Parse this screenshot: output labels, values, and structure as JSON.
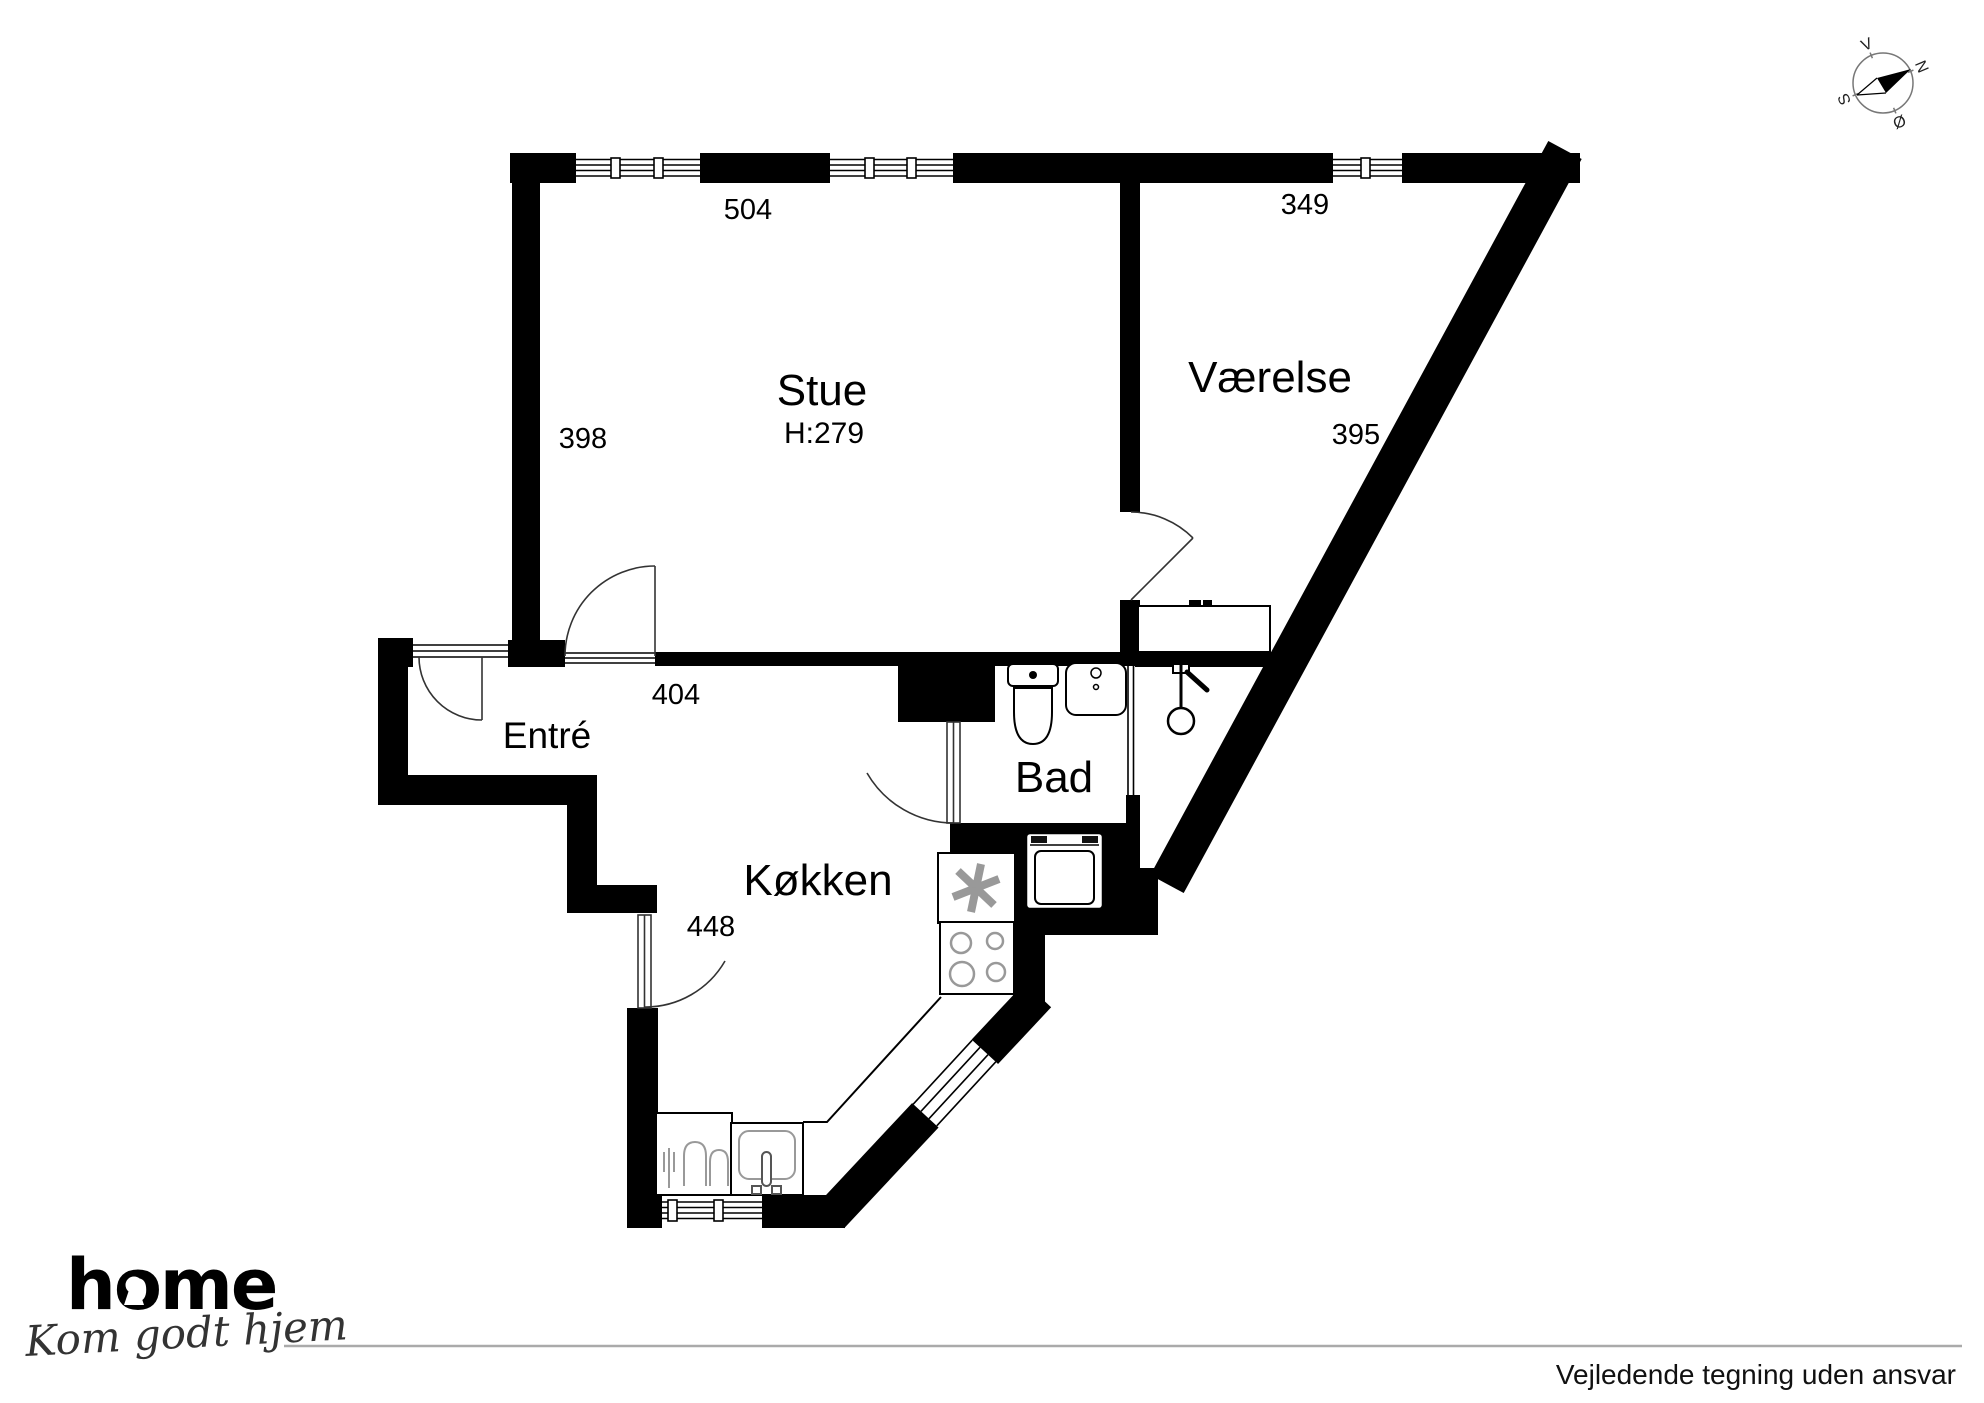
{
  "plan": {
    "rooms": {
      "stue": {
        "label": "Stue",
        "ceiling_height": "H:279",
        "width_cm": "504",
        "depth_cm": "398",
        "opening_cm": "404"
      },
      "vaerelse": {
        "label": "Værelse",
        "width_cm": "349",
        "depth_cm": "395"
      },
      "entre": {
        "label": "Entré"
      },
      "koekken": {
        "label": "Køkken",
        "width_cm": "448"
      },
      "bad": {
        "label": "Bad"
      }
    }
  },
  "compass": {
    "north": "N",
    "south": "S",
    "east": "Ø",
    "west": "V"
  },
  "branding": {
    "logo_text": "home",
    "tagline": "Kom godt hjem",
    "logo_color": "#e6252c"
  },
  "footer": {
    "disclaimer": "Vejledende tegning uden ansvar"
  },
  "colors": {
    "walls": "#000000",
    "fixtures": "#999999",
    "compass_ring": "#777777"
  }
}
